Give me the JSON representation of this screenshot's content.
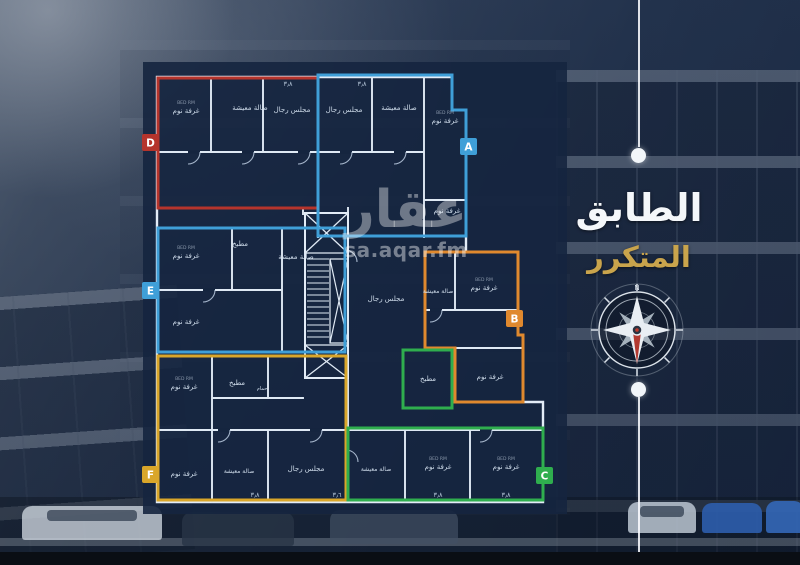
{
  "header": {
    "title_line1": "الطابق",
    "title_line2": "المتكرر",
    "title_color": "#f4f7fa",
    "accent_gold": "#c9a44c"
  },
  "watermark": {
    "brand": "عقار",
    "site": "sa.aqar.fm"
  },
  "compass": {
    "north_label": "N"
  },
  "plan": {
    "units": [
      {
        "id": "A",
        "color": "#3f9fd8"
      },
      {
        "id": "B",
        "color": "#e0892e"
      },
      {
        "id": "C",
        "color": "#2fae4e"
      },
      {
        "id": "D",
        "color": "#b5342c"
      },
      {
        "id": "E",
        "color": "#3f9fd8"
      },
      {
        "id": "F",
        "color": "#d9a62a"
      }
    ],
    "room_labels": {
      "bedroom": "غرفة نوم",
      "bedroom_en": "BED RM",
      "living": "صالة معيشة",
      "majlis": "مجلس رجال",
      "kitchen": "مطبخ",
      "bath": "حمام"
    },
    "dimensions": {
      "d38": "٣٫٨",
      "d36": "٣٫٦"
    }
  }
}
